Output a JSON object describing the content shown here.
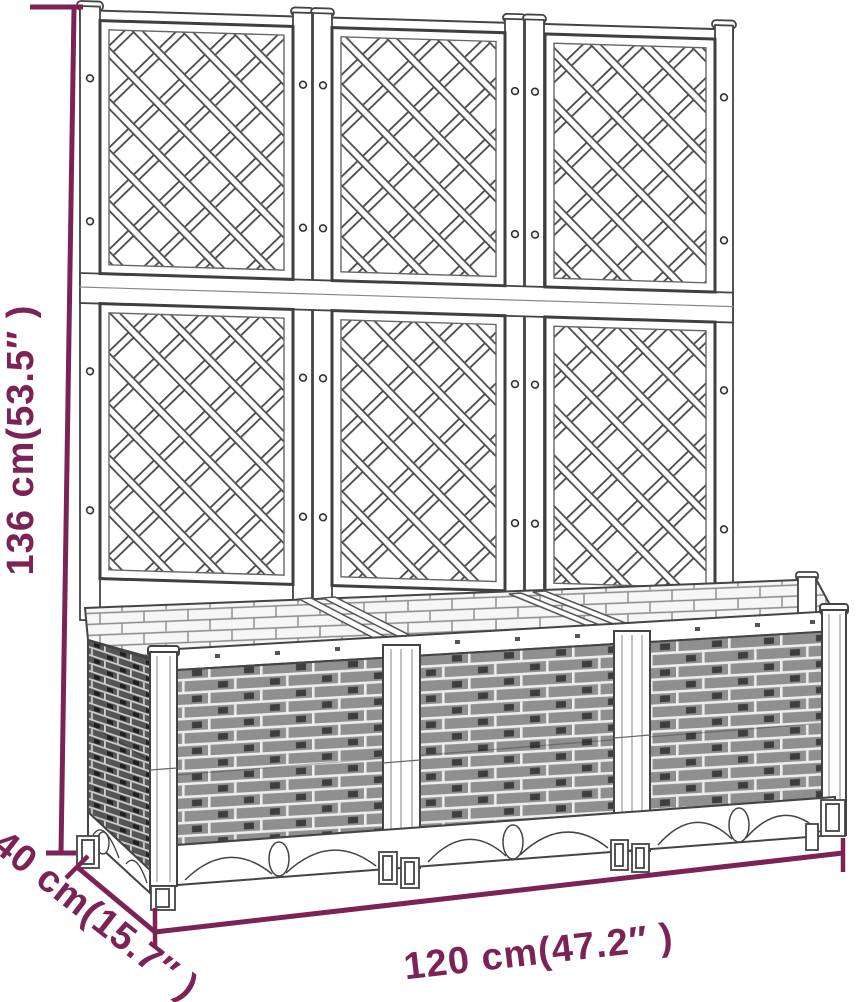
{
  "diagram": {
    "subject": "garden-planter-with-trellis",
    "accent_color": "#7c2356",
    "line_color": "#444444",
    "trellis_panel_rows": 2,
    "trellis_panels_per_row": 3,
    "planter_sections": 3,
    "dimensions": {
      "height_label": "136 cm(53.5″ )",
      "width_label": "120 cm(47.2″ )",
      "depth_label": "40 cm(15.7″ )"
    }
  }
}
